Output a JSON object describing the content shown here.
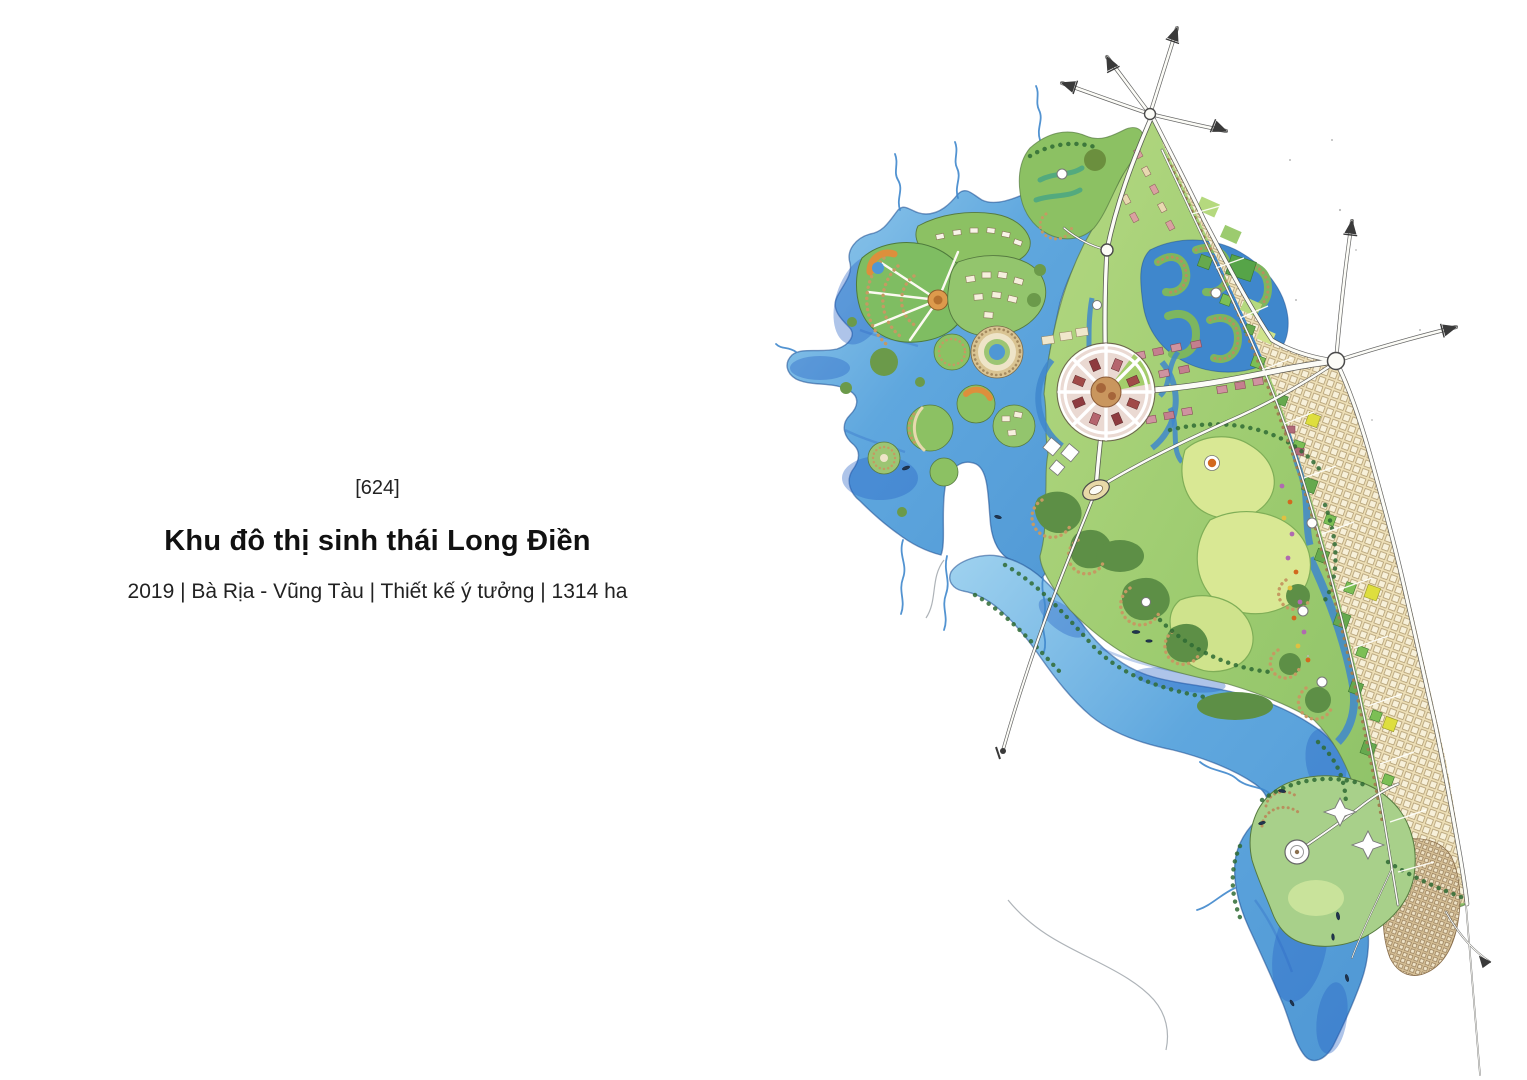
{
  "page": {
    "background_color": "#ffffff"
  },
  "caption": {
    "index": "[624]",
    "title": "Khu đô thị sinh thái Long Điền",
    "meta": "2019 | Bà Rịa - Vũng Tàu | Thiết kế ý tưởng | 1314 ha"
  },
  "map": {
    "type": "hand-drawn watercolor masterplan illustration",
    "alt": "Watercolor masterplan drawing of the Long Điền eco-urban area: a river estuary with canal-island neighborhoods on the west, a central radial plaza, a serpentine lagoon district, golf parkland, a gridded coastal boulevard strip on the east edge, a harbor resort at the south, and road axes ending in sketched arrows.",
    "features": [
      "river-estuary",
      "canal-island-neighborhoods",
      "central-radial-plaza",
      "serpentine-lagoon-district",
      "golf-parkland",
      "coastal-boulevard-grid",
      "harbor-resort",
      "road-axes-with-arrows",
      "boats",
      "pier-causeway"
    ],
    "palette": {
      "water_light": "#8ec9ec",
      "water_mid": "#4f97d4",
      "water_deep": "#2a62c4",
      "land_green": "#9ccb6f",
      "meadow_light": "#d9e894",
      "forest_dark": "#4e8a44",
      "block_tan": "#eee0b8",
      "plaza_pink": "#cf93a0",
      "plaza_center_brown": "#c9965e",
      "road_white": "#fcfcf7",
      "ink_outline": "#4a4a4a",
      "accent_orange": "#d2691e",
      "accent_yellow": "#dede3e"
    }
  }
}
